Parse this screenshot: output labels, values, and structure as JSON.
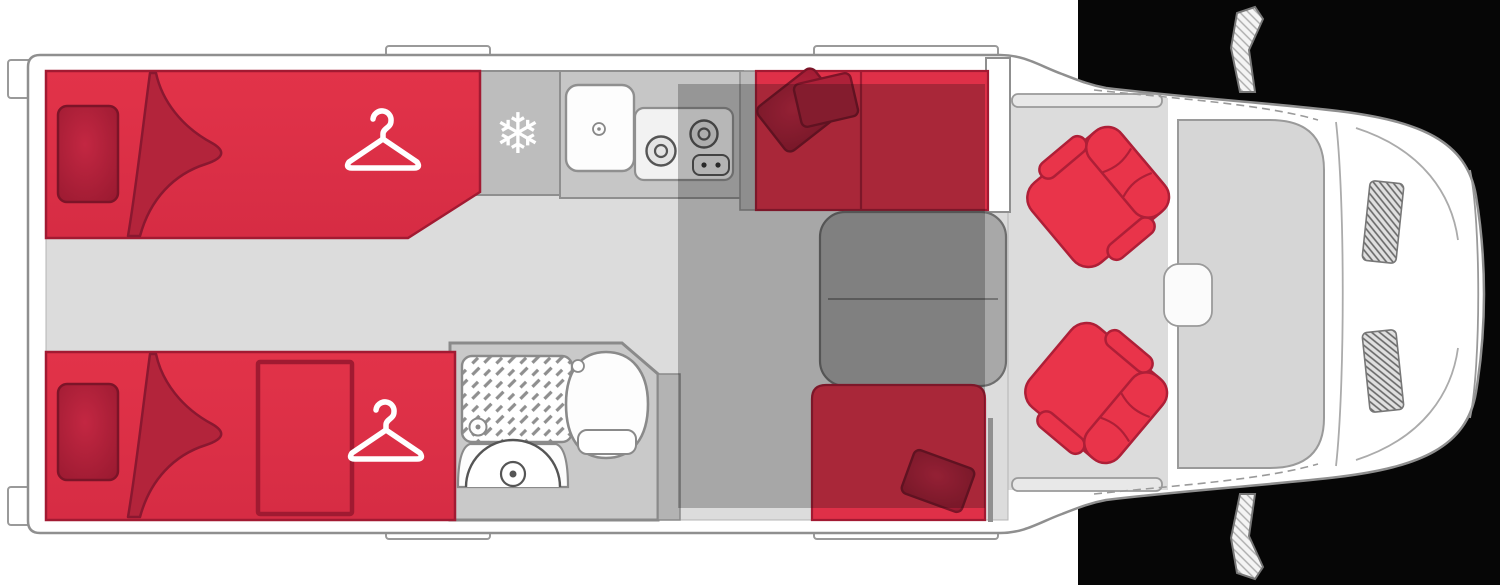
{
  "page": {
    "title": "Motorhome floor plan - top view",
    "width_px": 1500,
    "height_px": 585
  },
  "colors": {
    "bed_red": "#DF3048",
    "seat_red": "#E9344A",
    "red_edge": "#A21A32",
    "cushion_red": "#A51D33",
    "cushion_edge": "#7C1428",
    "blanket_red": "#B3243B",
    "floor_gray": "#DCDCDC",
    "unit_gray": "#C6C6C6",
    "fridge_gray": "#BDBDBD",
    "panel_gray": "#BBBBBB",
    "table_gray": "#A8A8A8",
    "bath_gray": "#C9C9C9",
    "strip_gray": "#B3B3B3",
    "wall_stroke": "#8F8F8F",
    "line_gray": "#9A9A9A",
    "dark_line": "#6E6E6E",
    "windshield_gray": "#D6D6D6",
    "body_white": "#FFFFFF",
    "backdrop_black": "#060606",
    "fixture_white": "#FDFDFD",
    "overlay_shadow": "rgba(15,15,15,0.26)"
  },
  "icons": {
    "snowflake": {
      "meaning": "fridge-freezer",
      "glyph": "❄"
    },
    "hanger": {
      "meaning": "wardrobe"
    }
  },
  "features": {
    "rear_top_bed": "single bed",
    "rear_bottom_bed": "single bed",
    "fridge": "fridge-freezer",
    "kitchen": "sink and two-burner hob",
    "bathroom": "shower, washbasin, toilet",
    "dinette": "half-dinette bench with table",
    "drop_down_bed": "drop-down bed shaded zone",
    "cab_seats": "two swivel cab seats",
    "cab": "driver cab with mirrors"
  }
}
